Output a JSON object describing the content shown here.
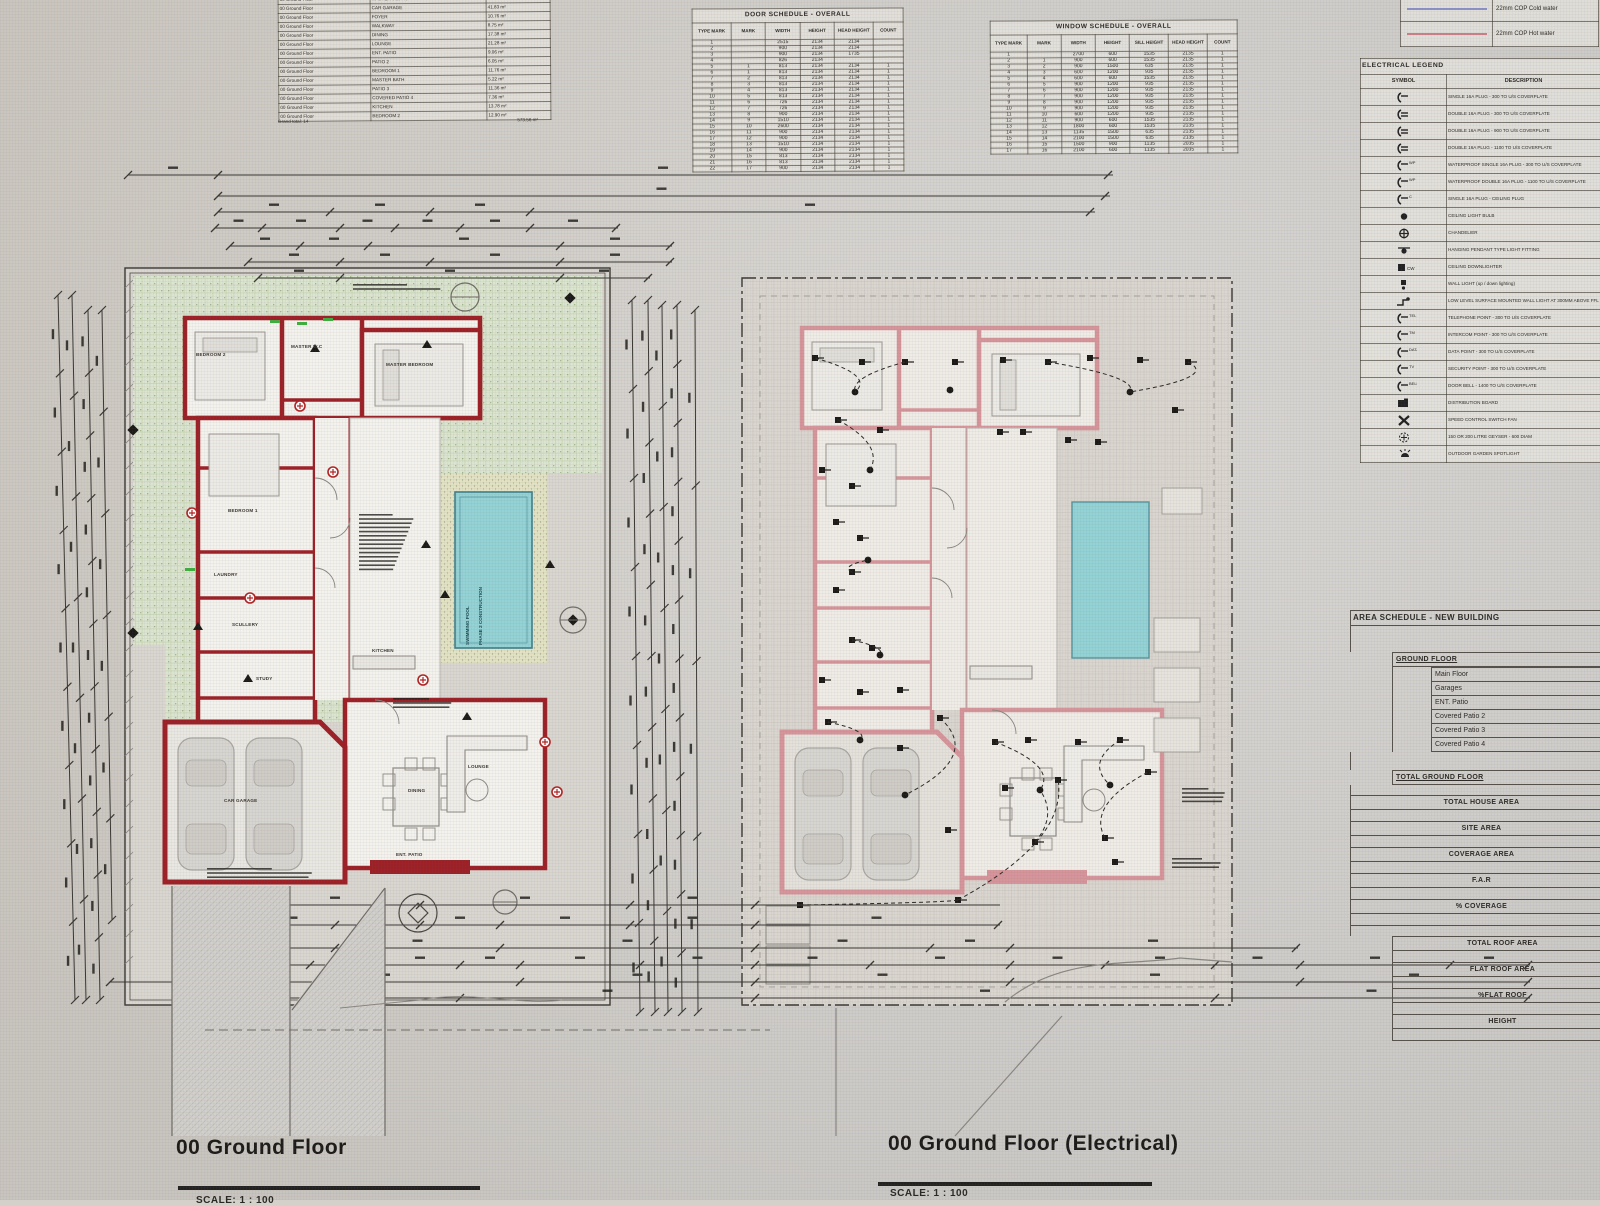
{
  "titles": {
    "left_plan": "00 Ground Floor",
    "right_plan": "00 Ground Floor (Electrical)",
    "scale": "SCALE: 1 : 100"
  },
  "room_schedule": {
    "rows": [
      [
        "00 Ground Floor",
        "MASTER BEDROOM",
        "25.07 m²"
      ],
      [
        "00 Ground Floor",
        "CAR GARAGE",
        "41.83 m²"
      ],
      [
        "00 Ground Floor",
        "FOYER",
        "10.76 m²"
      ],
      [
        "00 Ground Floor",
        "WALKWAY",
        "8.75 m²"
      ],
      [
        "00 Ground Floor",
        "DINING",
        "17.38 m²"
      ],
      [
        "00 Ground Floor",
        "LOUNGE",
        "21.28 m²"
      ],
      [
        "00 Ground Floor",
        "ENT. PATIO",
        "9.06 m²"
      ],
      [
        "00 Ground Floor",
        "PATIO 2",
        "6.05 m²"
      ],
      [
        "00 Ground Floor",
        "BEDROOM 1",
        "11.76 m²"
      ],
      [
        "00 Ground Floor",
        "MASTER BATH",
        "5.22 m²"
      ],
      [
        "00 Ground Floor",
        "PATIO 3",
        "11.36 m²"
      ],
      [
        "00 Ground Floor",
        "COVERED PATIO 4",
        "7.36 m²"
      ],
      [
        "00 Ground Floor",
        "KITCHEN",
        "13.78 m²"
      ],
      [
        "00 Ground Floor",
        "BEDROOM 2",
        "12.90 m²"
      ]
    ],
    "total_label": "Grand total: 14",
    "total_area": "573.56 m²"
  },
  "door_schedule": {
    "title": "DOOR SCHEDULE - OVERALL",
    "headers": [
      "TYPE MARK",
      "MARK",
      "WIDTH",
      "HEIGHT",
      "HEAD HEIGHT",
      "COUNT"
    ],
    "rows": [
      [
        "1",
        "",
        "2515",
        "2134",
        "2134",
        ""
      ],
      [
        "2",
        "",
        "900",
        "2134",
        "2134",
        ""
      ],
      [
        "3",
        "",
        "900",
        "2134",
        "1735",
        ""
      ],
      [
        "4",
        "",
        "826",
        "2134",
        "",
        ""
      ],
      [
        "5",
        "1",
        "813",
        "2134",
        "2134",
        "1"
      ],
      [
        "6",
        "1",
        "813",
        "2134",
        "2134",
        "1"
      ],
      [
        "7",
        "2",
        "813",
        "2134",
        "2134",
        "1"
      ],
      [
        "8",
        "3",
        "813",
        "2134",
        "2134",
        "1"
      ],
      [
        "9",
        "4",
        "813",
        "2134",
        "2134",
        "1"
      ],
      [
        "10",
        "5",
        "813",
        "2134",
        "2134",
        "1"
      ],
      [
        "11",
        "6",
        "726",
        "2134",
        "2134",
        "1"
      ],
      [
        "12",
        "7",
        "726",
        "2134",
        "2134",
        "1"
      ],
      [
        "13",
        "8",
        "900",
        "2134",
        "2134",
        "1"
      ],
      [
        "14",
        "9",
        "1510",
        "2134",
        "2134",
        "1"
      ],
      [
        "15",
        "10",
        "2600",
        "2134",
        "2134",
        "1"
      ],
      [
        "16",
        "11",
        "900",
        "2134",
        "2134",
        "1"
      ],
      [
        "17",
        "12",
        "900",
        "2134",
        "2134",
        "1"
      ],
      [
        "18",
        "13",
        "1510",
        "2134",
        "2134",
        "1"
      ],
      [
        "19",
        "14",
        "900",
        "2134",
        "2134",
        "1"
      ],
      [
        "20",
        "15",
        "813",
        "2134",
        "2134",
        "1"
      ],
      [
        "21",
        "16",
        "813",
        "2134",
        "2134",
        "1"
      ],
      [
        "22",
        "17",
        "900",
        "2134",
        "2134",
        "1"
      ]
    ]
  },
  "window_schedule": {
    "title": "WINDOW SCHEDULE - OVERALL",
    "headers": [
      "TYPE MARK",
      "MARK",
      "WIDTH",
      "HEIGHT",
      "SILL HEIGHT",
      "HEAD HEIGHT",
      "COUNT"
    ],
    "rows": [
      [
        "1",
        "",
        "2700",
        "600",
        "1535",
        "2135",
        "1"
      ],
      [
        "2",
        "1",
        "900",
        "600",
        "1535",
        "2135",
        "1"
      ],
      [
        "3",
        "2",
        "900",
        "1500",
        "635",
        "2135",
        "1"
      ],
      [
        "4",
        "3",
        "600",
        "1200",
        "935",
        "2135",
        "1"
      ],
      [
        "5",
        "4",
        "600",
        "600",
        "1535",
        "2135",
        "1"
      ],
      [
        "6",
        "5",
        "900",
        "1200",
        "935",
        "2135",
        "1"
      ],
      [
        "7",
        "6",
        "900",
        "1200",
        "935",
        "2135",
        "1"
      ],
      [
        "8",
        "7",
        "900",
        "1200",
        "935",
        "2135",
        "1"
      ],
      [
        "9",
        "8",
        "900",
        "1200",
        "935",
        "2135",
        "1"
      ],
      [
        "10",
        "9",
        "900",
        "1200",
        "935",
        "2135",
        "1"
      ],
      [
        "11",
        "10",
        "600",
        "1200",
        "935",
        "2135",
        "1"
      ],
      [
        "12",
        "11",
        "900",
        "600",
        "1535",
        "2135",
        "1"
      ],
      [
        "13",
        "12",
        "1800",
        "600",
        "1535",
        "2135",
        "1"
      ],
      [
        "14",
        "13",
        "1135",
        "1500",
        "635",
        "2135",
        "1"
      ],
      [
        "15",
        "14",
        "2100",
        "1500",
        "635",
        "2135",
        "1"
      ],
      [
        "16",
        "15",
        "1500",
        "900",
        "1135",
        "2035",
        "1"
      ],
      [
        "17",
        "16",
        "2100",
        "600",
        "1135",
        "2035",
        "1"
      ]
    ]
  },
  "pipe_legend": {
    "items": [
      {
        "color": "#8a93c8",
        "label": "22mm COP Cold water"
      },
      {
        "color": "#c97f86",
        "label": "22mm COP Hot water"
      }
    ]
  },
  "electrical_legend": {
    "title": "ELECTRICAL LEGEND",
    "headers": [
      "SYMBOL",
      "DESCRIPTION"
    ],
    "rows": [
      {
        "icon": "plug-single",
        "label": "SINGLE 16A PLUG - 300 TO U/S COVERPLATE"
      },
      {
        "icon": "plug-double",
        "label": "DOUBLE 16A PLUG - 300 TO U/S COVERPLATE"
      },
      {
        "icon": "plug-double",
        "label": "DOUBLE 16A PLUG - 900 TO U/S COVERPLATE"
      },
      {
        "icon": "plug-double",
        "label": "DOUBLE 16A PLUG - 1100 TO U/S COVERPLATE"
      },
      {
        "icon": "plug-wp",
        "label": "WATERPROOF SINGLE 16A PLUG - 300 TO U/S COVERPLATE"
      },
      {
        "icon": "plug-wp",
        "label": "WATERPROOF DOUBLE 16A PLUG - 1100 TO U/S COVERPLATE"
      },
      {
        "icon": "plug-ceiling",
        "label": "SINGLE 16A PLUG - CEILING PLUG"
      },
      {
        "icon": "dot",
        "label": "CEILING LIGHT BULB"
      },
      {
        "icon": "chandelier",
        "label": "CHANDELIER"
      },
      {
        "icon": "pendant",
        "label": "HANGING PENDANT TYPE LIGHT FITTING"
      },
      {
        "icon": "downlighter",
        "label": "CEILING DOWNLIGHTER"
      },
      {
        "icon": "wall-light",
        "label": "WALL LIGHT (up / down lighting)"
      },
      {
        "icon": "foot-light",
        "label": "LOW LEVEL SURFACE MOUNTED WALL LIGHT AT 300MM ABOVE FFL (FOOT LIGHT)"
      },
      {
        "icon": "tel",
        "label": "TELEPHONE POINT - 300 TO U/S COVERPLATE"
      },
      {
        "icon": "tm",
        "label": "INTERCOM POINT - 300 TO U/S COVERPLATE"
      },
      {
        "icon": "data",
        "label": "DATA POINT - 300 TO U/S COVERPLATE"
      },
      {
        "icon": "tv",
        "label": "SECURITY POINT - 300 TO U/S COVERPLATE"
      },
      {
        "icon": "bell",
        "label": "DOOR BELL - 1400 TO U/S COVERPLATE"
      },
      {
        "icon": "db",
        "label": "DISTRIBUTION BOARD"
      },
      {
        "icon": "fan",
        "label": "SPEED CONTROL SWITCH FAN"
      },
      {
        "icon": "geyser",
        "label": "150 OR 200 LITRE GEYSER - 600 DIAM"
      },
      {
        "icon": "spot",
        "label": "OUTDOOR GARDEN SPOTLIGHT"
      }
    ]
  },
  "area_schedule": {
    "title": "AREA SCHEDULE - NEW BUILDING",
    "ground_floor_label": "GROUND FLOOR",
    "ground_items": [
      "Main Floor",
      "Garages",
      "ENT. Patio",
      "Covered Patio 2",
      "Covered Patio 3",
      "Covered Patio 4"
    ],
    "total_ground_label": "TOTAL GROUND FLOOR",
    "summary_rows": [
      "TOTAL HOUSE AREA",
      "SITE AREA",
      "COVERAGE AREA",
      "F.A.R",
      "% COVERAGE"
    ],
    "roof_rows": [
      "TOTAL ROOF AREA",
      "FLAT ROOF AREA",
      "%FLAT ROOF",
      "HEIGHT"
    ]
  },
  "plan_labels": {
    "pool_line1": "SWIMMING POOL",
    "pool_line2": "PHASE 2 CONSTRUCTION",
    "rooms": [
      {
        "label": "BEDROOM 2",
        "x": 196,
        "y": 352
      },
      {
        "label": "MASTER W.C",
        "x": 291,
        "y": 344
      },
      {
        "label": "MASTER BEDROOM",
        "x": 386,
        "y": 362
      },
      {
        "label": "BEDROOM 1",
        "x": 228,
        "y": 508
      },
      {
        "label": "LAUNDRY",
        "x": 214,
        "y": 572
      },
      {
        "label": "SCULLERY",
        "x": 232,
        "y": 622
      },
      {
        "label": "STUDY",
        "x": 256,
        "y": 676
      },
      {
        "label": "KITCHEN",
        "x": 372,
        "y": 648
      },
      {
        "label": "CAR GARAGE",
        "x": 224,
        "y": 798
      },
      {
        "label": "DINING",
        "x": 408,
        "y": 788
      },
      {
        "label": "LOUNGE",
        "x": 468,
        "y": 764
      },
      {
        "label": "ENT. PATIO",
        "x": 396,
        "y": 852
      }
    ]
  },
  "colors": {
    "wall_red": "#9c2026",
    "wall_pink": "#d6959a",
    "pool": "#93d2d5",
    "garden": "#dbe4cf",
    "ink": "#3a3733"
  }
}
